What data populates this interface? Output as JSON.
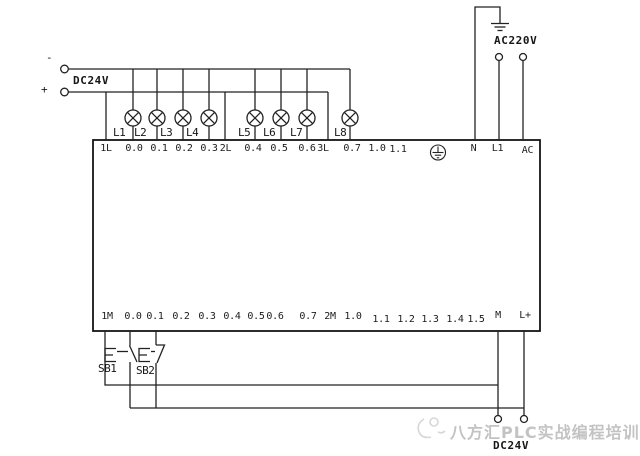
{
  "dc_supply": {
    "label": "DC24V",
    "minus": "-",
    "plus": "+"
  },
  "ac_supply": {
    "label": "AC220V"
  },
  "lamps": [
    "L1",
    "L2",
    "L3",
    "L4",
    "L5",
    "L6",
    "L7",
    "L8"
  ],
  "plc": {
    "top_terminals": [
      "1L",
      "0.0",
      "0.1",
      "0.2",
      "0.3",
      "2L",
      "0.4",
      "0.5",
      "0.6",
      "3L",
      "0.7",
      "1.0",
      "1.1",
      "N",
      "L1",
      "AC"
    ],
    "bottom_terminals": [
      "1M",
      "0.0",
      "0.1",
      "0.2",
      "0.3",
      "0.4",
      "0.5",
      "0.6",
      "0.7",
      "2M",
      "1.0",
      "1.1",
      "1.2",
      "1.3",
      "1.4",
      "1.5",
      "M",
      "L+"
    ]
  },
  "buttons": [
    "SB1",
    "SB2"
  ],
  "bottom_supply": {
    "label": "DC24V"
  },
  "watermark": {
    "text": "八方汇PLC实战编程培训"
  },
  "colors": {
    "line": "#1f1f1f",
    "watermark": "#c3c3c3",
    "background": "#ffffff"
  }
}
